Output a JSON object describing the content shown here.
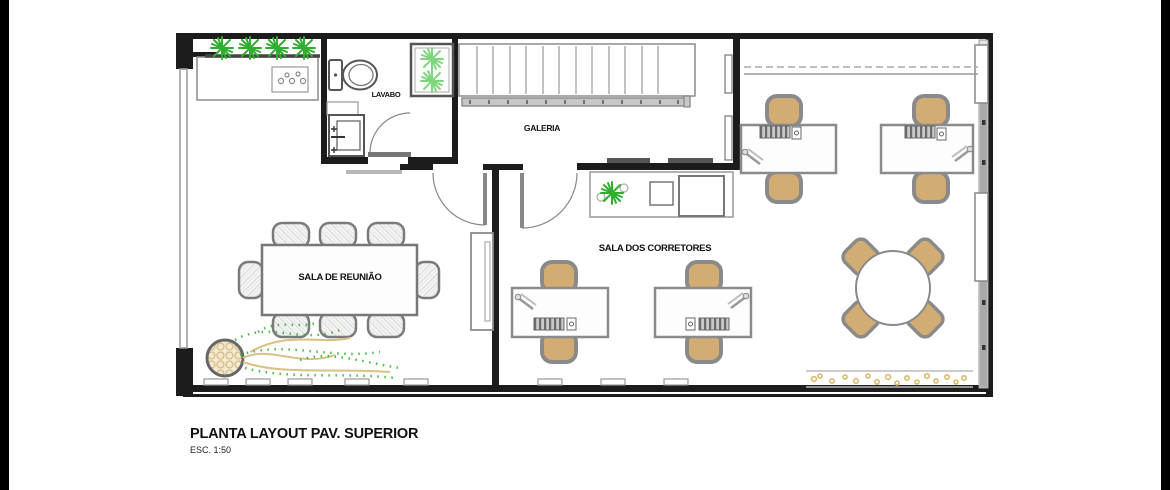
{
  "drawing": {
    "title": "PLANTA LAYOUT PAV. SUPERIOR",
    "scale": "ESC. 1:50",
    "rooms": {
      "lavabo": "LAVABO",
      "galeria": "GALERIA",
      "sala_reuniao": "SALA DE REUNIÃO",
      "sala_corretores": "SALA DOS CORRETORES"
    },
    "colors": {
      "wall": "#1c1c1c",
      "line_gray": "#8c8c8c",
      "chair_tan": "#d2ac72",
      "chair_border": "#8a8a8a",
      "plant_green": "#2fae2f",
      "plant_light_green": "#7fd67f",
      "pot_tan": "#d9c08a",
      "pebble_tan": "#dcba6c"
    },
    "icons": [
      "toilet-icon",
      "sink-icon",
      "staircase-icon",
      "door-arc-icon",
      "plant-icon",
      "potted-plant-icon",
      "keyboard-icon",
      "phone-icon",
      "pen-icon",
      "chair-icon",
      "round-table-icon",
      "meeting-table-icon",
      "desk-icon",
      "pebble-strip-icon"
    ]
  }
}
